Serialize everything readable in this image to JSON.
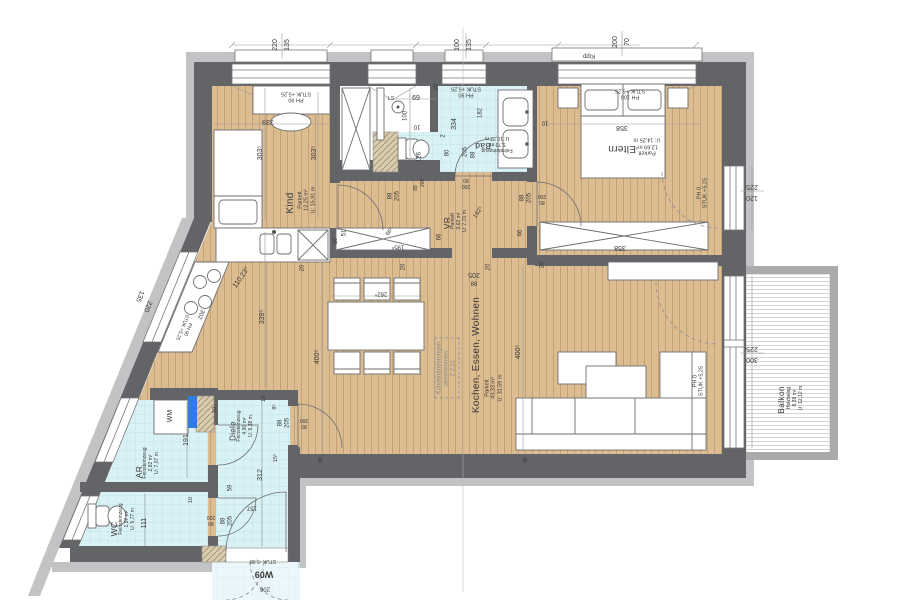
{
  "drawing_type": "apartment floor plan",
  "unit_label": "W09",
  "colors": {
    "wall_dark": "#636468",
    "wall_light": "#c2c3c5",
    "parquet": "#dcbd92",
    "parquet_stripe": "#c8a172",
    "tile": "#daf1f5",
    "tile_grid": "#b5e2ea",
    "hatch": "#d9cdb0",
    "shaft_blue": "#2f7de1",
    "deck": "#ffffff"
  },
  "rooms": [
    {
      "id": "kind",
      "name": "Kind",
      "floor": "Parkett",
      "area": "12,25 m²",
      "perimeter": "U: 15,91 m",
      "name_pos": [
        291,
        203,
        -90,
        10
      ],
      "details_pos": [
        307,
        200,
        -90,
        5.5
      ]
    },
    {
      "id": "bad",
      "name": "Bad",
      "floor": "Feinsteinzeug",
      "area": "5,70 m²",
      "perimeter": "U: 10,32 m",
      "name_pos": [
        483,
        146,
        180,
        8.5
      ],
      "details_pos": [
        497,
        143,
        180,
        5
      ]
    },
    {
      "id": "eltern",
      "name": "Eltern",
      "floor": "Parkett",
      "area": "12,69 m²",
      "perimeter": "U: 14,25 m",
      "name_pos": [
        622,
        148,
        180,
        10
      ],
      "details_pos": [
        647,
        146,
        180,
        5.5
      ]
    },
    {
      "id": "vr",
      "name": "VR",
      "floor": "Parkett",
      "area": "3,62 m²",
      "perimeter": "U: 7,71 m",
      "name_pos": [
        447,
        223,
        -90,
        8.5
      ],
      "details_pos": [
        460,
        221,
        -90,
        5
      ]
    },
    {
      "id": "wohnen",
      "name": "Kochen, Essen, Wohnen",
      "floor": "Parkett",
      "area": "43,33 m²",
      "perimeter": "U: 31,59 m",
      "name_pos": [
        477,
        355,
        -90,
        10
      ],
      "details_pos": [
        494,
        388,
        -90,
        5.5
      ]
    },
    {
      "id": "diele",
      "name": "Diele",
      "floor": "Feinsteinzeug",
      "area": "4,90 m²",
      "perimeter": "U: 9,38 m",
      "name_pos": [
        233,
        431,
        -90,
        8
      ],
      "details_pos": [
        246,
        426,
        -90,
        5
      ]
    },
    {
      "id": "ar",
      "name": "AR",
      "floor": "Feinsteinzeug",
      "area": "2,82 m²",
      "perimeter": "U: 7,07 m",
      "name_pos": [
        139,
        472,
        -90,
        8.5
      ],
      "details_pos": [
        152,
        463,
        -90,
        5
      ]
    },
    {
      "id": "wc",
      "name": "WC",
      "floor": "Feinsteinzeug",
      "area": "1,97 m²",
      "perimeter": "U: 5,77 m",
      "name_pos": [
        114,
        529,
        -90,
        8.5
      ],
      "details_pos": [
        128,
        519,
        -90,
        5
      ]
    },
    {
      "id": "balkon",
      "name": "Balkon",
      "floor": "Holzbelag",
      "area": "8,38 m²",
      "perimeter": "U: 12,12 m",
      "name_pos": [
        781,
        400,
        -90,
        8.5
      ],
      "details_pos": [
        796,
        398,
        -90,
        5
      ]
    }
  ],
  "labels": [
    {
      "n": "dim-window-kind-w",
      "t": "220",
      "x": 276,
      "y": 45,
      "r": -90,
      "s": 7
    },
    {
      "n": "dim-window-kind-h",
      "t": "135",
      "x": 288,
      "y": 45,
      "r": -90,
      "s": 7
    },
    {
      "n": "dim-window-bad-w",
      "t": "100",
      "x": 458,
      "y": 45,
      "r": -90,
      "s": 7
    },
    {
      "n": "dim-window-bad-h",
      "t": "135",
      "x": 470,
      "y": 45,
      "r": -90,
      "s": 7
    },
    {
      "n": "dim-window-eltern-w",
      "t": "200",
      "x": 616,
      "y": 42,
      "r": -90,
      "s": 7
    },
    {
      "n": "dim-window-eltern-h",
      "t": "70",
      "x": 628,
      "y": 42,
      "r": -90,
      "s": 7
    },
    {
      "n": "kipp-label",
      "t": "Kipp",
      "x": 589,
      "y": 55,
      "r": 180,
      "s": 6
    },
    {
      "n": "dim-door-eltern-right-h",
      "t": "225",
      "x": 752,
      "y": 186,
      "r": 180,
      "s": 7
    },
    {
      "n": "dim-door-eltern-right-w",
      "t": "120",
      "x": 752,
      "y": 197,
      "r": 180,
      "s": 7
    },
    {
      "n": "dim-window-wohnen-h",
      "t": "225",
      "x": 752,
      "y": 348,
      "r": 180,
      "s": 7
    },
    {
      "n": "dim-window-wohnen-w",
      "t": "300",
      "x": 752,
      "y": 359,
      "r": 180,
      "s": 7
    },
    {
      "n": "dim-window-kitchen-h",
      "t": "135",
      "x": 139,
      "y": 296,
      "r": 112,
      "s": 7
    },
    {
      "n": "dim-window-kitchen-w",
      "t": "220",
      "x": 147,
      "y": 306,
      "r": 112,
      "s": 7
    },
    {
      "t": "302",
      "x": 200,
      "y": 314,
      "r": 112,
      "s": 6
    },
    {
      "n": "parapet-kitchen",
      "t": "PH 90\nSTUK +5,25",
      "x": 184,
      "y": 328,
      "r": 112,
      "s": 5
    },
    {
      "n": "parapet-kind",
      "t": "PH 90\nSTUK +5,25",
      "x": 296,
      "y": 96,
      "r": 180,
      "s": 5.5
    },
    {
      "n": "parapet-bad",
      "t": "PH 90\nSTUK +5,25",
      "x": 466,
      "y": 91,
      "r": 180,
      "s": 5.5
    },
    {
      "n": "parapet-eltern",
      "t": "PH 100\nSTUK +5,25",
      "x": 630,
      "y": 93,
      "r": 180,
      "s": 5.5
    },
    {
      "n": "parapet-eltern-door",
      "t": "PH 0\nSTUK +5,25",
      "x": 703,
      "y": 193,
      "r": -90,
      "s": 5.5
    },
    {
      "n": "parapet-balkon-door",
      "t": "PH 0\nSTUK +5,25",
      "x": 699,
      "y": 381,
      "r": -90,
      "s": 5.5
    },
    {
      "t": "339",
      "x": 268,
      "y": 121,
      "r": 180,
      "s": 7
    },
    {
      "t": "303⁵",
      "x": 261,
      "y": 153,
      "r": -90,
      "s": 7
    },
    {
      "t": "303⁵",
      "x": 315,
      "y": 153,
      "r": -90,
      "s": 7
    },
    {
      "t": "69",
      "x": 416,
      "y": 99,
      "r": 0,
      "s": 7
    },
    {
      "n": "ls-label",
      "t": "LS",
      "x": 391,
      "y": 99,
      "r": 0,
      "s": 5.5
    },
    {
      "t": "100",
      "x": 406,
      "y": 116,
      "r": -90,
      "s": 6
    },
    {
      "t": "20",
      "x": 437,
      "y": 87,
      "r": -90,
      "s": 6
    },
    {
      "t": "334",
      "x": 455,
      "y": 124,
      "r": -90,
      "s": 7
    },
    {
      "t": "182",
      "x": 481,
      "y": 113,
      "r": -90,
      "s": 6
    },
    {
      "t": "2",
      "x": 444,
      "y": 136,
      "r": -90,
      "s": 6
    },
    {
      "t": "80",
      "x": 448,
      "y": 153,
      "r": -90,
      "s": 6
    },
    {
      "t": "205",
      "x": 466,
      "y": 152,
      "r": -90,
      "s": 6
    },
    {
      "t": "88",
      "x": 474,
      "y": 155,
      "r": -90,
      "s": 6
    },
    {
      "t": "126",
      "x": 420,
      "y": 157,
      "r": -90,
      "s": 6
    },
    {
      "t": "10",
      "x": 417,
      "y": 126,
      "r": 180,
      "s": 6
    },
    {
      "t": "358",
      "x": 622,
      "y": 127,
      "r": 180,
      "s": 7
    },
    {
      "t": "10",
      "x": 545,
      "y": 122,
      "r": 180,
      "s": 6
    },
    {
      "t": "88",
      "x": 523,
      "y": 198,
      "r": -90,
      "s": 6
    },
    {
      "t": "205",
      "x": 530,
      "y": 198,
      "r": -90,
      "s": 6
    },
    {
      "t": "200",
      "x": 542,
      "y": 195,
      "r": 180,
      "s": 5
    },
    {
      "t": "80",
      "x": 542,
      "y": 201,
      "r": 180,
      "s": 5
    },
    {
      "t": "88",
      "x": 391,
      "y": 196,
      "r": -90,
      "s": 6
    },
    {
      "t": "205",
      "x": 398,
      "y": 196,
      "r": -90,
      "s": 6
    },
    {
      "t": "200",
      "x": 424,
      "y": 183,
      "r": -90,
      "s": 5
    },
    {
      "t": "88",
      "x": 417,
      "y": 188,
      "r": -90,
      "s": 5
    },
    {
      "t": "80",
      "x": 466,
      "y": 179,
      "r": 180,
      "s": 5
    },
    {
      "t": "200",
      "x": 466,
      "y": 185,
      "r": 180,
      "s": 5
    },
    {
      "t": "162⁵",
      "x": 479,
      "y": 213,
      "r": -55,
      "s": 6
    },
    {
      "t": "66",
      "x": 440,
      "y": 237,
      "r": -90,
      "s": 6
    },
    {
      "t": "66⁵",
      "x": 390,
      "y": 232,
      "r": -55,
      "s": 5.5
    },
    {
      "t": "195⁵",
      "x": 398,
      "y": 246,
      "r": 180,
      "s": 6
    },
    {
      "t": "51",
      "x": 345,
      "y": 233,
      "r": -90,
      "s": 6
    },
    {
      "t": "358",
      "x": 620,
      "y": 247,
      "r": 180,
      "s": 7
    },
    {
      "t": "205",
      "x": 474,
      "y": 274,
      "r": 180,
      "s": 7
    },
    {
      "t": "88",
      "x": 474,
      "y": 282,
      "r": 180,
      "s": 6
    },
    {
      "t": "20",
      "x": 404,
      "y": 267,
      "r": -90,
      "s": 6
    },
    {
      "t": "20",
      "x": 489,
      "y": 267,
      "r": -90,
      "s": 6
    },
    {
      "t": "262⁵",
      "x": 381,
      "y": 293,
      "r": 180,
      "s": 6
    },
    {
      "t": "400⁵",
      "x": 318,
      "y": 357,
      "r": -90,
      "s": 7
    },
    {
      "t": "400⁵",
      "x": 519,
      "y": 352,
      "r": -90,
      "s": 7
    },
    {
      "t": "339⁵",
      "x": 263,
      "y": 317,
      "r": -90,
      "s": 7
    },
    {
      "n": "angle-label",
      "t": "110,23°",
      "x": 242,
      "y": 278,
      "r": -55,
      "s": 7
    },
    {
      "n": "change-note",
      "t": "Kundenänderungen\nübernommen:\n2.2.21",
      "x": 447,
      "y": 368,
      "r": -90,
      "s": 6,
      "cls": "box"
    },
    {
      "t": "8⁵",
      "x": 275,
      "y": 407,
      "r": -90,
      "s": 5.5
    },
    {
      "t": "10",
      "x": 264,
      "y": 399,
      "r": -90,
      "s": 5.5
    },
    {
      "t": "88",
      "x": 281,
      "y": 423,
      "r": -90,
      "s": 6
    },
    {
      "t": "205",
      "x": 288,
      "y": 423,
      "r": -90,
      "s": 6
    },
    {
      "t": "200",
      "x": 304,
      "y": 419,
      "r": 180,
      "s": 5
    },
    {
      "t": "80",
      "x": 304,
      "y": 425,
      "r": 180,
      "s": 5
    },
    {
      "t": "312",
      "x": 261,
      "y": 475,
      "r": -90,
      "s": 7
    },
    {
      "t": "59",
      "x": 231,
      "y": 488,
      "r": -90,
      "s": 6
    },
    {
      "t": "157",
      "x": 252,
      "y": 507,
      "r": 180,
      "s": 6
    },
    {
      "t": "15⁵",
      "x": 276,
      "y": 458,
      "r": -90,
      "s": 5.5
    },
    {
      "t": "191",
      "x": 187,
      "y": 440,
      "r": -90,
      "s": 7
    },
    {
      "t": "111",
      "x": 145,
      "y": 523,
      "r": -90,
      "s": 7
    },
    {
      "t": "10",
      "x": 191,
      "y": 500,
      "r": -90,
      "s": 5.5
    },
    {
      "t": "10",
      "x": 215,
      "y": 410,
      "r": -90,
      "s": 5.5
    },
    {
      "n": "wm-label",
      "t": "WM",
      "x": 171,
      "y": 416,
      "r": -90,
      "s": 7
    },
    {
      "t": "88",
      "x": 224,
      "y": 521,
      "r": -90,
      "s": 6
    },
    {
      "t": "205",
      "x": 231,
      "y": 521,
      "r": -90,
      "s": 6
    },
    {
      "t": "200",
      "x": 211,
      "y": 516,
      "r": 180,
      "s": 5
    },
    {
      "t": "80",
      "x": 211,
      "y": 522,
      "r": 180,
      "s": 5
    },
    {
      "n": "entry-level",
      "t": "STUK -5,08",
      "x": 263,
      "y": 560,
      "r": 180,
      "s": 5
    },
    {
      "n": "entry-door-id",
      "t": "W09",
      "x": 264,
      "y": 574,
      "r": 180,
      "s": 9,
      "cls": "bold"
    },
    {
      "n": "entry-door-width",
      "t": "206",
      "x": 265,
      "y": 588,
      "r": 180,
      "s": 6
    },
    {
      "t": "30",
      "x": 321,
      "y": 460,
      "r": -90,
      "s": 5.5
    },
    {
      "t": "30",
      "x": 526,
      "y": 460,
      "r": -90,
      "s": 5.5
    },
    {
      "t": "20",
      "x": 303,
      "y": 268,
      "r": -90,
      "s": 6
    },
    {
      "t": "10",
      "x": 336,
      "y": 241,
      "r": -90,
      "s": 5.5
    },
    {
      "t": "20",
      "x": 543,
      "y": 265,
      "r": -90,
      "s": 6
    },
    {
      "t": "66",
      "x": 521,
      "y": 233,
      "r": -90,
      "s": 6
    }
  ]
}
